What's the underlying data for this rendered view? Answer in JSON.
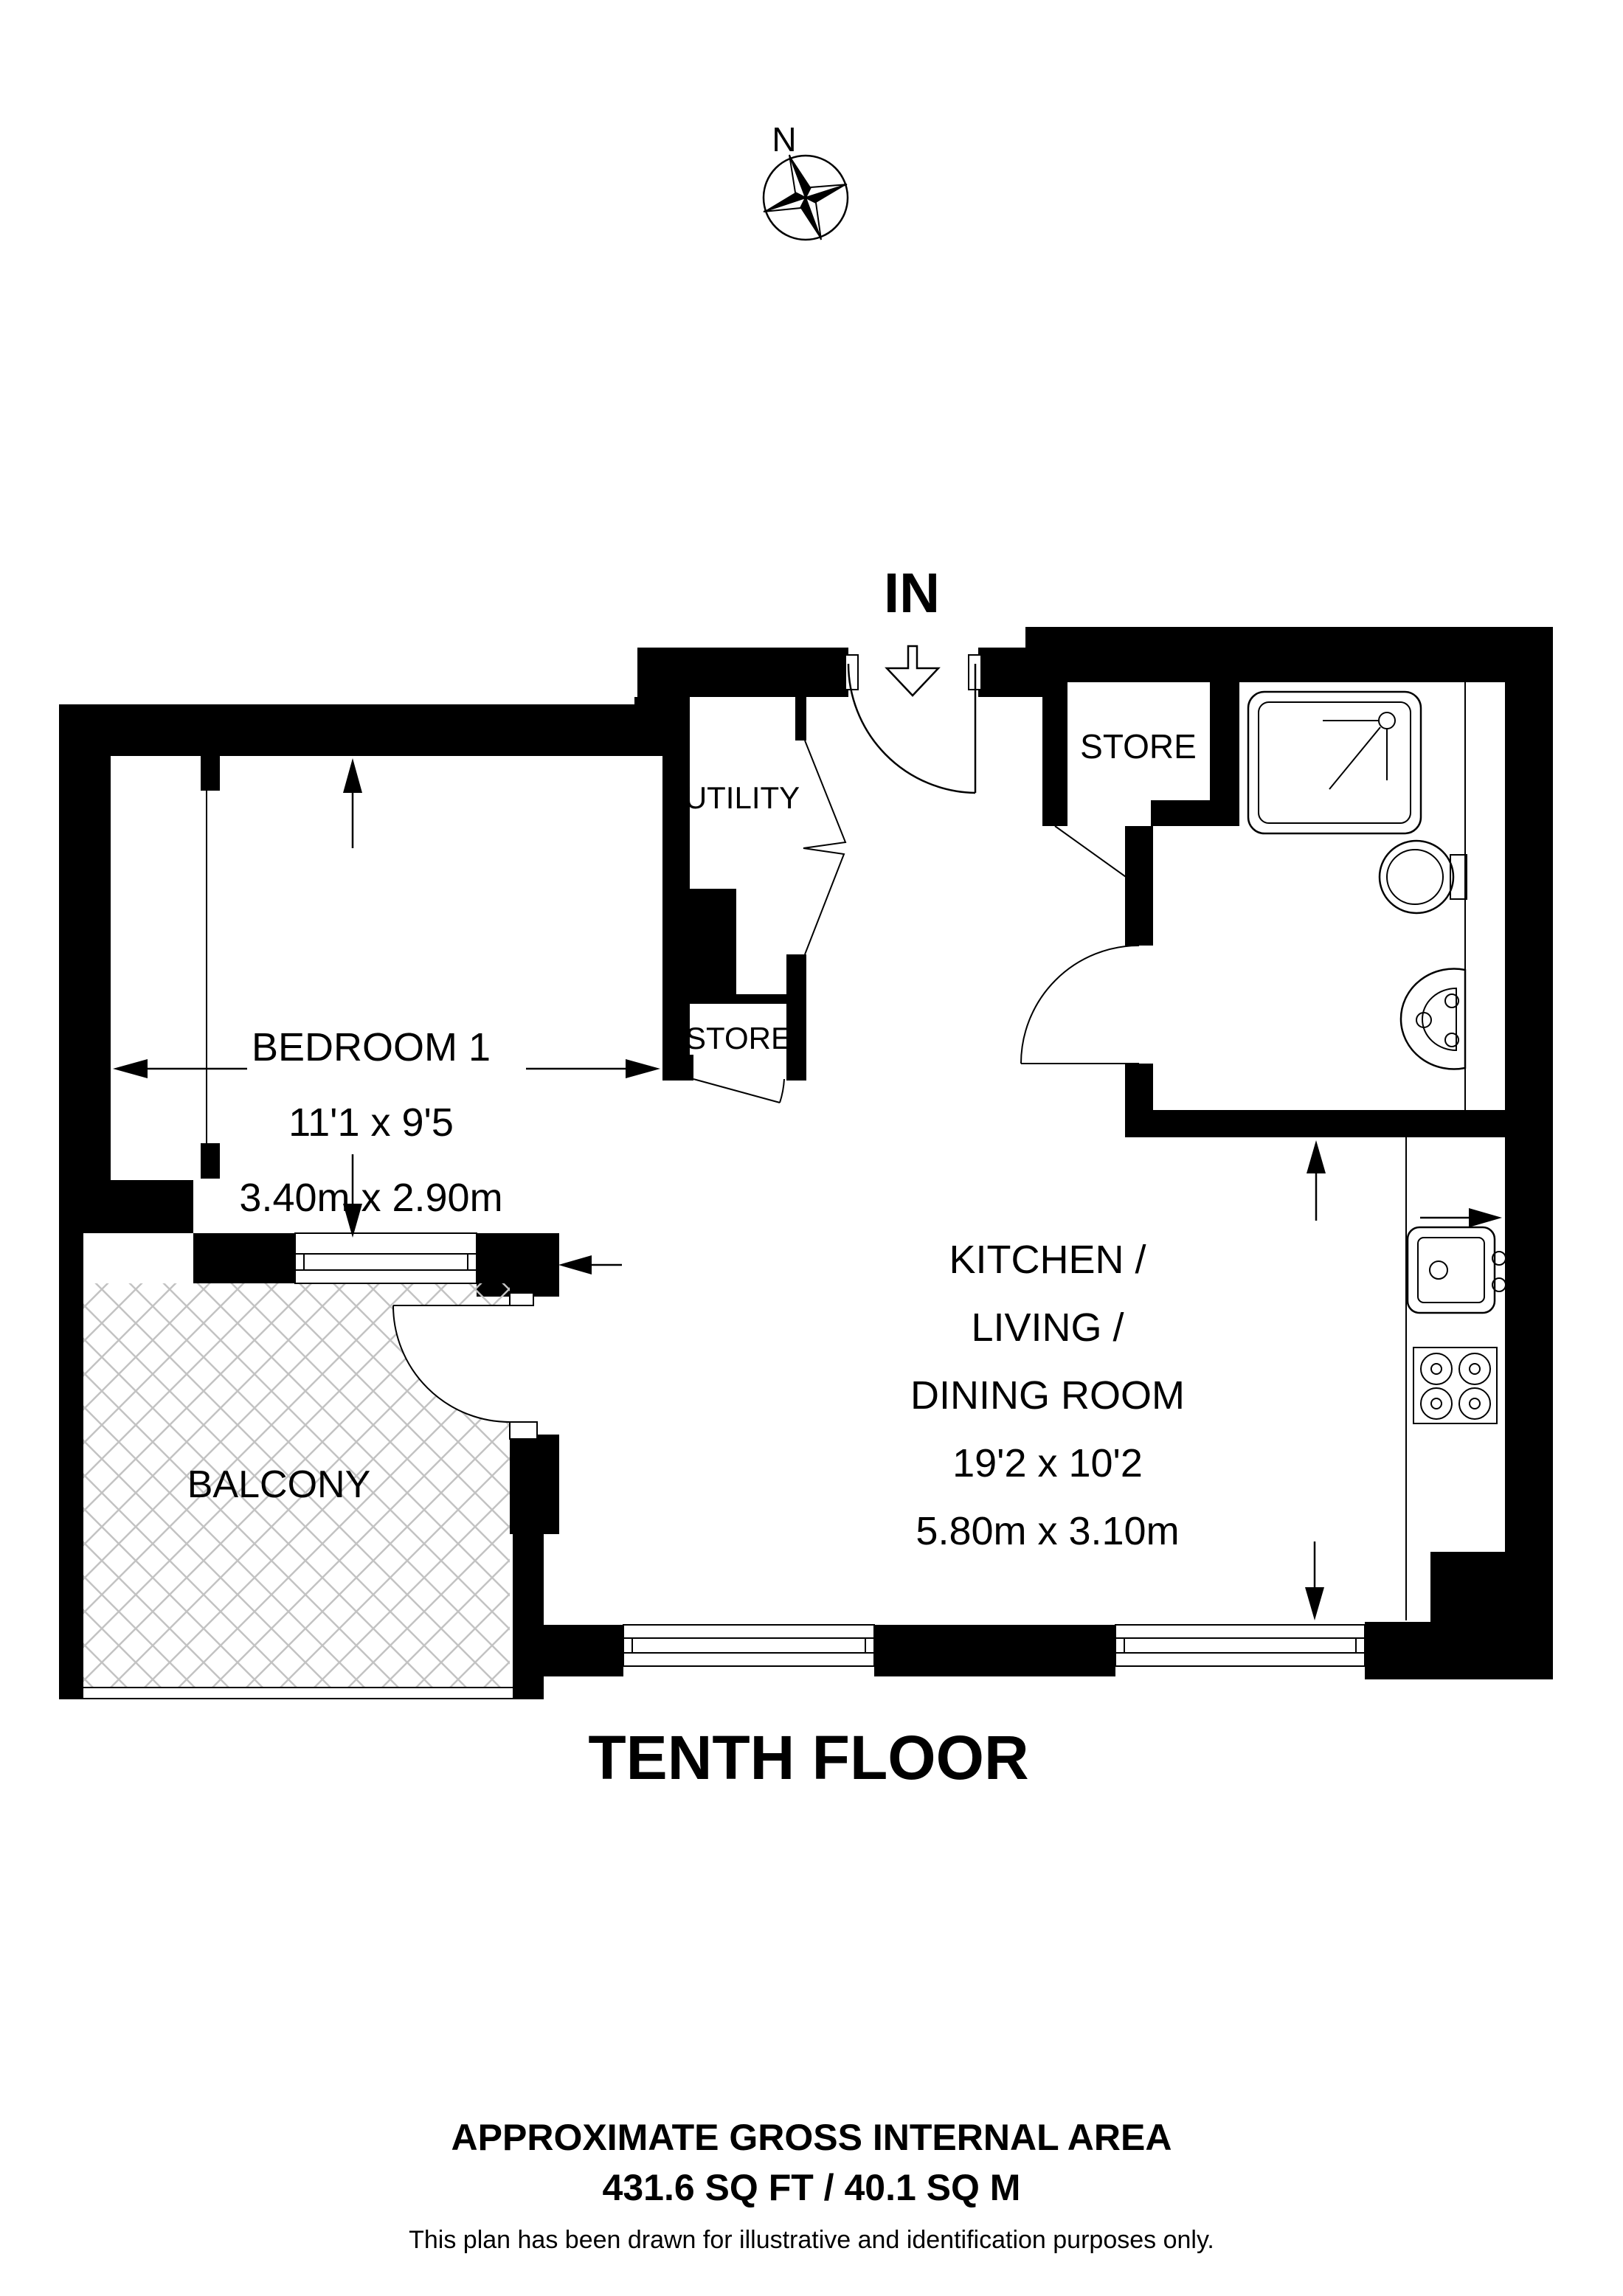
{
  "compass": {
    "north_label": "N"
  },
  "entrance": {
    "label": "IN"
  },
  "rooms": {
    "bedroom": {
      "name": "BEDROOM 1",
      "imperial": "11'1 x 9'5",
      "metric": "3.40m x 2.90m"
    },
    "kitchen": {
      "line1": "KITCHEN /",
      "line2": "LIVING /",
      "line3": "DINING ROOM",
      "imperial": "19'2 x 10'2",
      "metric": "5.80m x 3.10m"
    },
    "utility": {
      "name": "UTILITY"
    },
    "store_inner": {
      "name": "STORE"
    },
    "store_entrance": {
      "name": "STORE"
    },
    "balcony": {
      "name": "BALCONY"
    }
  },
  "floor_title": "TENTH FLOOR",
  "footer": {
    "line1": "APPROXIMATE GROSS INTERNAL AREA",
    "line2": "431.6 SQ FT / 40.1 SQ M",
    "line3": "This plan has been drawn for illustrative and identification purposes only."
  },
  "colors": {
    "walls": "#000000",
    "hatch": "#c3c3c3",
    "background": "#ffffff"
  }
}
